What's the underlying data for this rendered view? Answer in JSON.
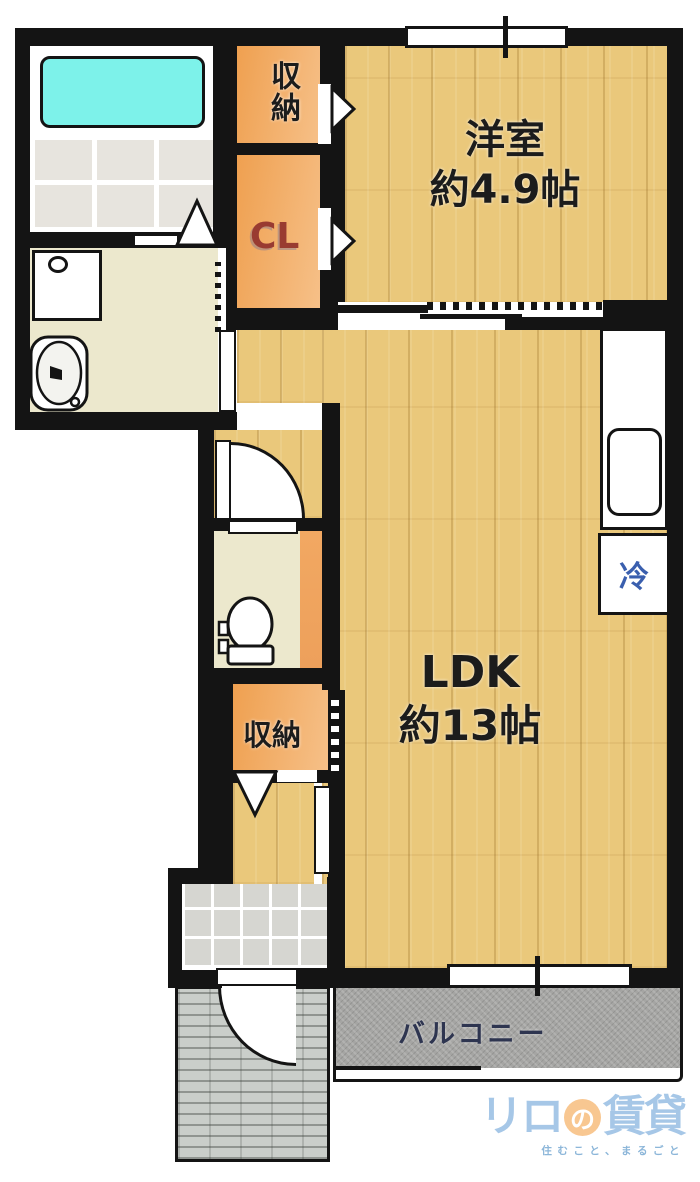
{
  "floorplan": {
    "rooms": {
      "western_room": {
        "label": "洋室",
        "area": "約4.9帖"
      },
      "ldk": {
        "label": "LDK",
        "area": "約13帖"
      },
      "storage_top": {
        "label": "収納"
      },
      "closet": {
        "label": "CL"
      },
      "storage_lower": {
        "label": "収納"
      },
      "refrigerator": {
        "label": "冷"
      },
      "balcony": {
        "label": "バルコニー"
      }
    },
    "colors": {
      "wall_black": "#141414",
      "wood_floor": "#eac87b",
      "closet_orange": "#f0a55c",
      "bathtub_cyan": "#7df2ea",
      "mat_beige": "#ece8cd",
      "balcony_gray": "#a5a5a3",
      "cl_text": "#993b31",
      "fridge_text": "#3a5fae",
      "balcony_text": "#2e3550",
      "logo_blue": "#a6c7e7",
      "logo_orange": "#f8c791"
    }
  },
  "logo": {
    "brand_part1": "リロ",
    "brand_circle": "の",
    "brand_part2": "賃貸",
    "tagline": "住むこと、まるごと"
  }
}
